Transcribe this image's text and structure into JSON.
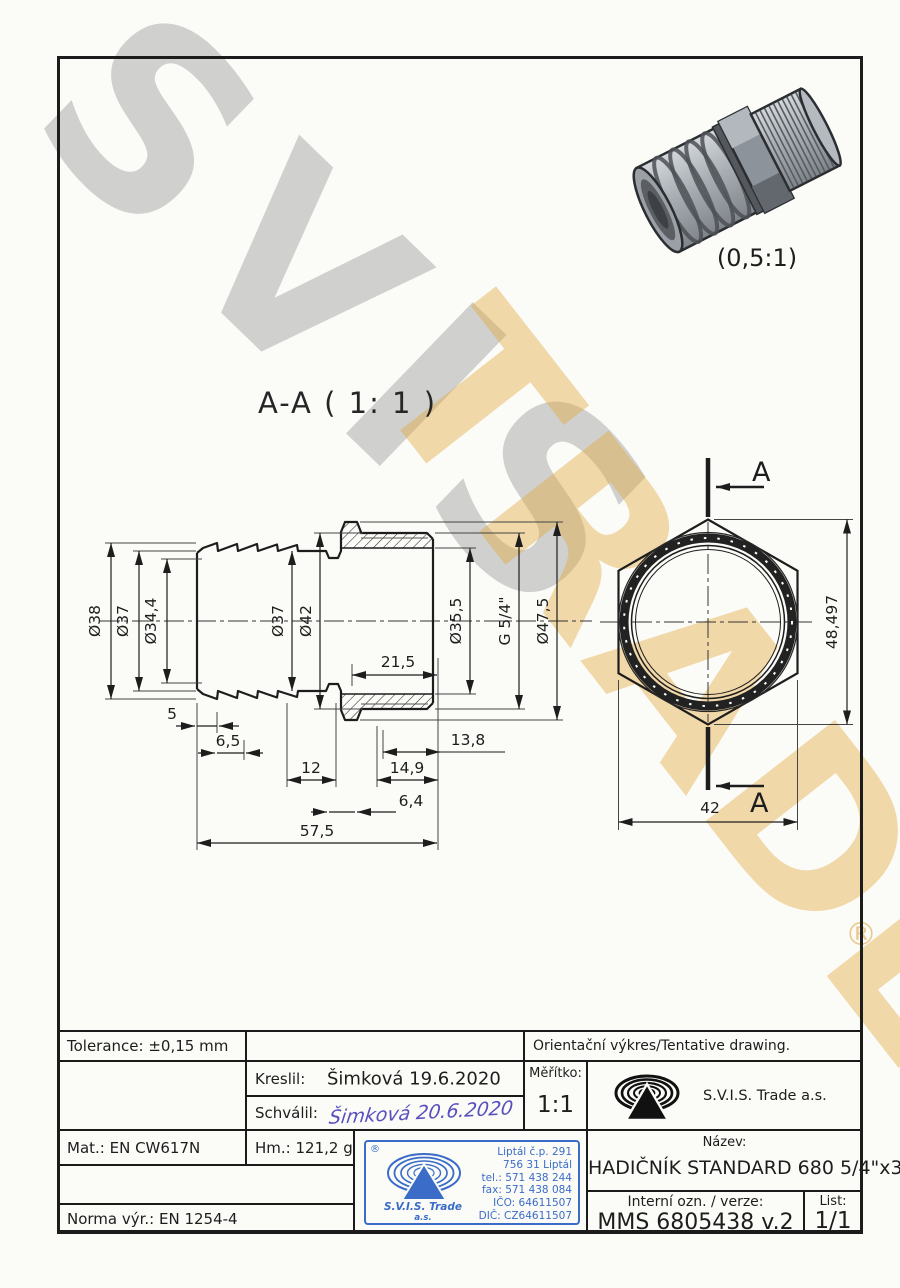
{
  "watermarks": {
    "svis": "SVIS",
    "trade": "TRADE",
    "reg": "®"
  },
  "labels": {
    "section_title": "A-A ( 1: 1 )",
    "scale_3d": "(0,5:1)",
    "cut_letter_top": "A",
    "cut_letter_bottom": "A"
  },
  "dims": {
    "dia38": "Ø38",
    "dia37_left": "Ø37",
    "dia34_4": "Ø34,4",
    "dia37_mid": "Ø37",
    "dia42": "Ø42",
    "dia35_5": "Ø35,5",
    "g_thread": "G 5/4\"",
    "dia47_5": "Ø47,5",
    "l21_5": "21,5",
    "l5": "5",
    "l6_5": "6,5",
    "l12": "12",
    "l13_8": "13,8",
    "l14_9": "14,9",
    "l6_4": "6,4",
    "l57_5": "57,5",
    "hex_across_corners": "48,497",
    "hex_across_flats": "42"
  },
  "title_block": {
    "tolerance": "Tolerance: ±0,15 mm",
    "orient_note": "Orientační výkres/Tentative drawing.",
    "kreslil_label": "Kreslil:",
    "kreslil_value": "Šimková 19.6.2020",
    "schvalil_label": "Schválil:",
    "schvalil_value": "Šimková 20.6.2020",
    "meritko_label": "Měřítko:",
    "meritko_value": "1:1",
    "company": "S.V.I.S. Trade a.s.",
    "mat": "Mat.: EN CW617N",
    "hm": "Hm.: 121,2 g",
    "norma": "Norma výr.: EN 1254-4",
    "nazev_label": "Název:",
    "nazev_value": "HADIČNÍK STANDARD 680 5/4\"x38",
    "interni_label": "Interní ozn. / verze:",
    "interni_value": "MMS 6805438 v.2",
    "list_label": "List:",
    "list_value": "1/1",
    "stamp": {
      "reg": "®",
      "l1": "Liptál č.p. 291",
      "l2": "756 31 Liptál",
      "l3": "tel.: 571 438 244",
      "l4": "fax: 571 438 084",
      "l5": "IČO: 64611507",
      "l6": "DIČ: CZ64611507",
      "company": "S.V.I.S. Trade",
      "suffix": "a.s."
    }
  },
  "colors": {
    "line": "#1d1d1d",
    "stamp_blue": "#3a6cc8",
    "signature_blue": "#584fbe",
    "watermark_gray": "#c6c6c6",
    "watermark_gold": "#eec27a"
  }
}
